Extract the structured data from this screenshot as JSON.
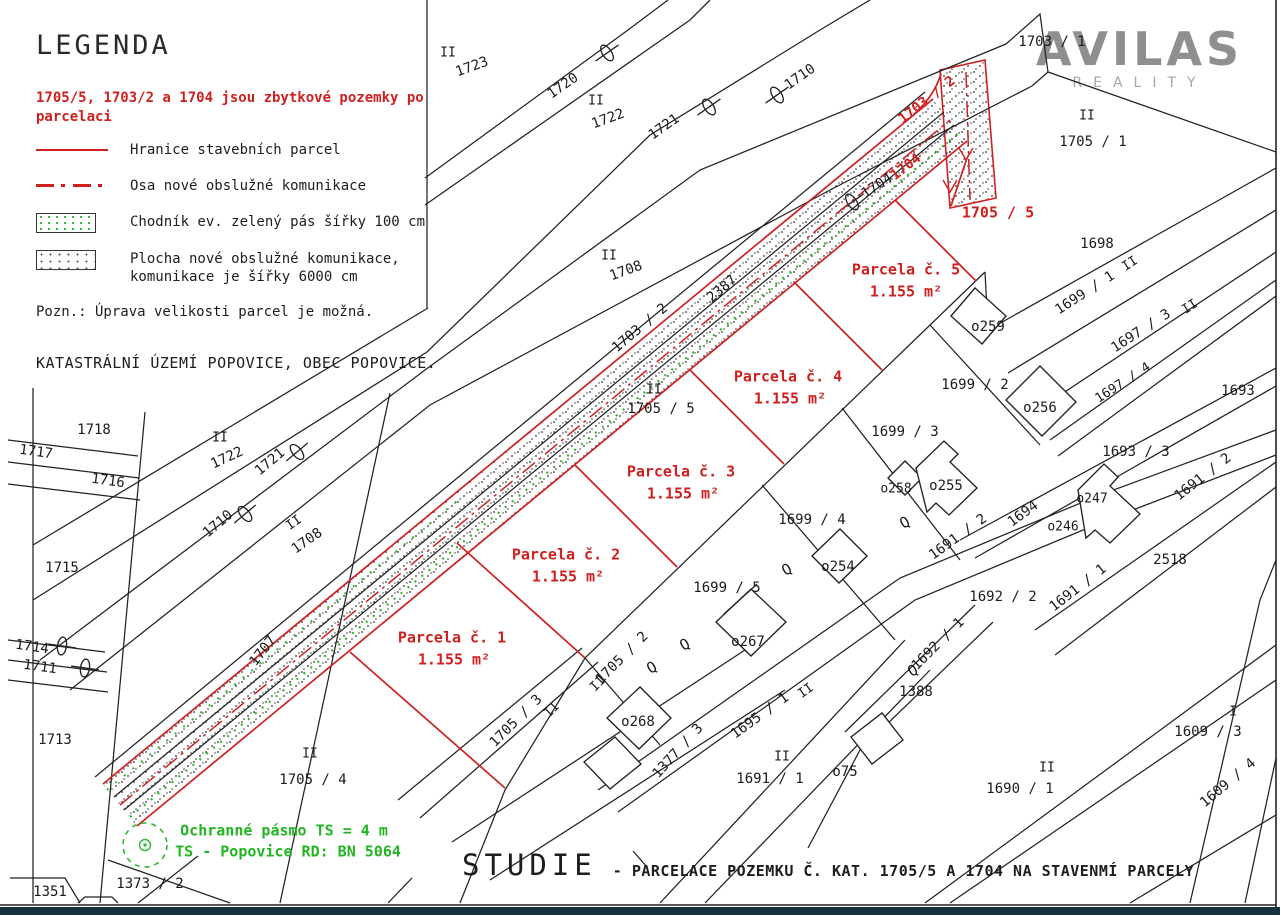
{
  "colors": {
    "red": "#cf1f1f",
    "green": "#21b521",
    "line_black": "#222222",
    "logo_gray": "#8f8f8f",
    "footer_bar": "#16323c"
  },
  "logo": {
    "brand": "AVILAS",
    "tagline": "REALITY"
  },
  "legend": {
    "title": "LEGENDA",
    "red_note": "1705/5, 1703/2 a 1704 jsou zbytkové pozemky po parcelaci",
    "items": [
      {
        "swatch": "red-line",
        "label": "Hranice stavebních parcel"
      },
      {
        "swatch": "red-dashdot",
        "label": "Osa nové obslužné komunikace"
      },
      {
        "swatch": "green-stipple",
        "label": "Chodník ev. zelený pás šířky 100 cm"
      },
      {
        "swatch": "dot-stipple",
        "label": "Plocha nové obslužné komunikace, komunikace je šířky 6000 cm"
      }
    ],
    "note": "Pozn.: Úprava velikosti parcel je možná.",
    "cadastre": "KATASTRÁLNÍ ÚZEMÍ POPOVICE, OBEC POPOVICE."
  },
  "title_block": {
    "main": "STUDIE",
    "subtitle": "- PARCELACE POZEMKU Č. KAT. 1705/5 A 1704 NA STAVENMÍ PARCELY"
  },
  "map": {
    "labels": [
      {
        "t": "II",
        "x": 448,
        "y": 53,
        "s": 13
      },
      {
        "t": "1723",
        "x": 472,
        "y": 67,
        "r": -20
      },
      {
        "t": "1720",
        "x": 563,
        "y": 86,
        "r": -35
      },
      {
        "t": "II",
        "x": 596,
        "y": 101,
        "s": 13
      },
      {
        "t": "1722",
        "x": 608,
        "y": 119,
        "r": -20
      },
      {
        "t": "1721",
        "x": 664,
        "y": 127,
        "r": -35
      },
      {
        "t": "1710",
        "x": 800,
        "y": 77,
        "r": -35
      },
      {
        "t": "1703 / 1",
        "x": 1052,
        "y": 42
      },
      {
        "t": "II",
        "x": 1087,
        "y": 116,
        "s": 13
      },
      {
        "t": "1705 / 1",
        "x": 1093,
        "y": 142
      },
      {
        "t": "II",
        "x": 609,
        "y": 256,
        "s": 13
      },
      {
        "t": "1708",
        "x": 626,
        "y": 271,
        "r": -20
      },
      {
        "t": "1703 / 2",
        "x": 640,
        "y": 328,
        "r": -40
      },
      {
        "t": "2387",
        "x": 722,
        "y": 289,
        "r": -40
      },
      {
        "t": "1704",
        "x": 877,
        "y": 186,
        "r": -33
      },
      {
        "t": "1704",
        "x": 906,
        "y": 167,
        "r": -38,
        "c": "r"
      },
      {
        "t": "1703 / 2",
        "x": 927,
        "y": 100,
        "r": -38,
        "c": "r"
      },
      {
        "t": "1705 / 5",
        "x": 998,
        "y": 213,
        "c": "r",
        "s": 15
      },
      {
        "t": "Parcela č. 5",
        "x": 906,
        "y": 270,
        "c": "r",
        "s": 15
      },
      {
        "t": "1.155 m²",
        "x": 906,
        "y": 292,
        "c": "r",
        "s": 15
      },
      {
        "t": "II",
        "x": 654,
        "y": 390,
        "s": 13
      },
      {
        "t": "1705 / 5",
        "x": 661,
        "y": 409
      },
      {
        "t": "Parcela č. 4",
        "x": 788,
        "y": 377,
        "c": "r",
        "s": 15
      },
      {
        "t": "1.155 m²",
        "x": 790,
        "y": 399,
        "c": "r",
        "s": 15
      },
      {
        "t": "Parcela č. 3",
        "x": 681,
        "y": 472,
        "c": "r",
        "s": 15
      },
      {
        "t": "1.155 m²",
        "x": 683,
        "y": 494,
        "c": "r",
        "s": 15
      },
      {
        "t": "Parcela č. 2",
        "x": 566,
        "y": 555,
        "c": "r",
        "s": 15
      },
      {
        "t": "1.155 m²",
        "x": 568,
        "y": 577,
        "c": "r",
        "s": 15
      },
      {
        "t": "Parcela č. 1",
        "x": 452,
        "y": 638,
        "c": "r",
        "s": 15
      },
      {
        "t": "1.155 m²",
        "x": 454,
        "y": 660,
        "c": "r",
        "s": 15
      },
      {
        "t": "1698",
        "x": 1097,
        "y": 244
      },
      {
        "t": "II",
        "x": 1130,
        "y": 264,
        "r": -33,
        "s": 13
      },
      {
        "t": "1699 / 1",
        "x": 1085,
        "y": 293,
        "r": -33
      },
      {
        "t": "II",
        "x": 1190,
        "y": 307,
        "r": -33,
        "s": 13
      },
      {
        "t": "1697 / 3",
        "x": 1141,
        "y": 331,
        "r": -33
      },
      {
        "t": "1697 / 4",
        "x": 1123,
        "y": 383,
        "r": -33,
        "s": 13
      },
      {
        "t": "1693",
        "x": 1238,
        "y": 391
      },
      {
        "t": "1699 / 2",
        "x": 975,
        "y": 385
      },
      {
        "t": "o259",
        "x": 988,
        "y": 327
      },
      {
        "t": "o256",
        "x": 1040,
        "y": 408
      },
      {
        "t": "1699 / 3",
        "x": 905,
        "y": 432
      },
      {
        "t": "o258",
        "x": 896,
        "y": 489,
        "s": 13
      },
      {
        "t": "o255",
        "x": 946,
        "y": 486
      },
      {
        "t": "1699 / 4",
        "x": 812,
        "y": 520
      },
      {
        "t": "o254",
        "x": 838,
        "y": 567
      },
      {
        "t": "1693 / 3",
        "x": 1136,
        "y": 452
      },
      {
        "t": "1691 / 2",
        "x": 1203,
        "y": 477,
        "r": -38
      },
      {
        "t": "o247",
        "x": 1092,
        "y": 499,
        "s": 13
      },
      {
        "t": "o246",
        "x": 1063,
        "y": 527,
        "s": 13
      },
      {
        "t": "2518",
        "x": 1170,
        "y": 560
      },
      {
        "t": "1691 / 1",
        "x": 1078,
        "y": 588,
        "r": -38
      },
      {
        "t": "1692 / 2",
        "x": 1003,
        "y": 597
      },
      {
        "t": "1691 / 2",
        "x": 958,
        "y": 537,
        "r": -36
      },
      {
        "t": "1694",
        "x": 1023,
        "y": 514,
        "r": -36
      },
      {
        "t": "1699 / 5",
        "x": 727,
        "y": 588
      },
      {
        "t": "o267",
        "x": 748,
        "y": 642
      },
      {
        "t": "o268",
        "x": 638,
        "y": 722
      },
      {
        "t": "1705 / 2",
        "x": 622,
        "y": 658,
        "r": -45
      },
      {
        "t": "II",
        "x": 598,
        "y": 684,
        "r": -45,
        "s": 13
      },
      {
        "t": "1705 / 3",
        "x": 516,
        "y": 721,
        "r": -45
      },
      {
        "t": "II",
        "x": 552,
        "y": 710,
        "r": -45,
        "s": 13
      },
      {
        "t": "1377 / 3",
        "x": 678,
        "y": 751,
        "r": -48
      },
      {
        "t": "1695 / 1",
        "x": 760,
        "y": 716,
        "r": -36
      },
      {
        "t": "II",
        "x": 806,
        "y": 691,
        "r": -36,
        "s": 13
      },
      {
        "t": "II",
        "x": 782,
        "y": 757,
        "s": 13
      },
      {
        "t": "1691 / 1",
        "x": 770,
        "y": 779
      },
      {
        "t": "o75",
        "x": 845,
        "y": 772
      },
      {
        "t": "Q",
        "x": 685,
        "y": 645,
        "r": -30,
        "s": 15
      },
      {
        "t": "Q",
        "x": 652,
        "y": 668,
        "r": -30,
        "s": 15
      },
      {
        "t": "Q",
        "x": 787,
        "y": 570,
        "r": -30,
        "s": 15
      },
      {
        "t": "Q",
        "x": 905,
        "y": 523,
        "r": -30,
        "s": 15
      },
      {
        "t": "Q",
        "x": 913,
        "y": 671,
        "r": -30,
        "s": 15
      },
      {
        "t": "1388",
        "x": 916,
        "y": 692
      },
      {
        "t": "1692 / 1",
        "x": 938,
        "y": 644,
        "r": -45
      },
      {
        "t": "II",
        "x": 1047,
        "y": 768,
        "s": 13
      },
      {
        "t": "1690 / 1",
        "x": 1020,
        "y": 789
      },
      {
        "t": "I",
        "x": 1233,
        "y": 712,
        "s": 13
      },
      {
        "t": "1609 / 3",
        "x": 1208,
        "y": 732
      },
      {
        "t": "1609 / 4",
        "x": 1228,
        "y": 783,
        "r": -40
      },
      {
        "t": "II",
        "x": 220,
        "y": 438,
        "s": 13
      },
      {
        "t": "1722",
        "x": 227,
        "y": 458,
        "r": -25
      },
      {
        "t": "1721",
        "x": 270,
        "y": 462,
        "r": -40
      },
      {
        "t": "1710",
        "x": 218,
        "y": 524,
        "r": -40
      },
      {
        "t": "II",
        "x": 294,
        "y": 523,
        "r": -35,
        "s": 13
      },
      {
        "t": "1708",
        "x": 307,
        "y": 541,
        "r": -35
      },
      {
        "t": "1718",
        "x": 94,
        "y": 430
      },
      {
        "t": "1717",
        "x": 36,
        "y": 452,
        "r": 8
      },
      {
        "t": "1716",
        "x": 108,
        "y": 481,
        "r": 8
      },
      {
        "t": "1715",
        "x": 62,
        "y": 568
      },
      {
        "t": "1714",
        "x": 32,
        "y": 647,
        "r": 8
      },
      {
        "t": "1711",
        "x": 40,
        "y": 667,
        "r": 8
      },
      {
        "t": "1707",
        "x": 263,
        "y": 651,
        "r": -52
      },
      {
        "t": "1713",
        "x": 55,
        "y": 740
      },
      {
        "t": "II",
        "x": 310,
        "y": 754,
        "s": 13
      },
      {
        "t": "1705 / 4",
        "x": 313,
        "y": 780
      },
      {
        "t": "1373 / 2",
        "x": 150,
        "y": 884
      },
      {
        "t": "1351",
        "x": 50,
        "y": 892
      },
      {
        "t": "Ochranné pásmo TS = 4 m",
        "x": 284,
        "y": 831,
        "c": "g",
        "s": 15
      },
      {
        "t": "TS - Popovice RD: BN 5064",
        "x": 288,
        "y": 852,
        "c": "g",
        "s": 15
      }
    ]
  }
}
